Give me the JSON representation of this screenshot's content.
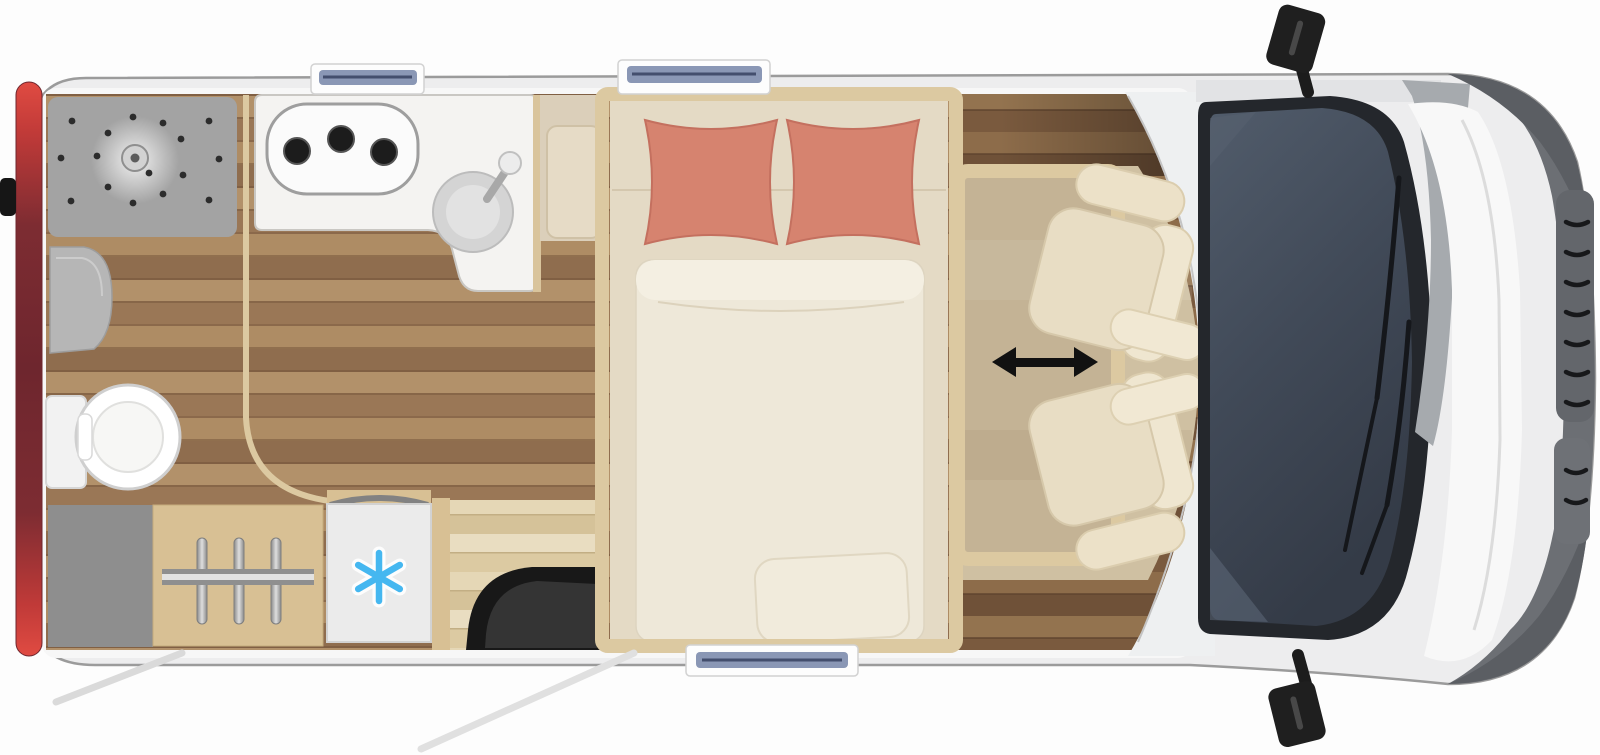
{
  "scene": {
    "type": "motorhome-floorplan-top-view",
    "vehicle_front": "right",
    "vehicle_rear": "left"
  },
  "colors": {
    "background": "#fdfdfd",
    "body_fill": "#ededee",
    "body_outline": "#9b9b9b",
    "wall_white": "#f7f7f7",
    "tail_light_bright": "#d94840",
    "tail_light_dark": "#6e262e",
    "floor_wood": "#a8875f",
    "floor_wood_dark": "#8a6848",
    "floor_pale": "#e4d6b6",
    "carpet_tan": "#cfc0a2",
    "furniture_beige": "#d8c094",
    "frame_beige": "#dcc9a1",
    "pillow_coral": "#d6836f",
    "headboard_cream": "#e4dac5",
    "duvet_cream": "#eee8d9",
    "seat_cream": "#e8ddc4",
    "counter_white": "#f4f3f1",
    "shower_gray": "#a3a3a3",
    "cabinet_gray": "#8e8e8e",
    "fridge_white": "#ebebeb",
    "snowflake_blue": "#45b7f0",
    "window_glass_blue": "#8a97b5",
    "windshield_glass": "#454e5c",
    "windshield_frame": "#24272c",
    "step_black": "#181818",
    "arrow_black": "#111111",
    "mirror_black": "#1f1f1f",
    "hood_white": "#f8f8f8",
    "front_rim_gray": "#6c6f74"
  },
  "zones": {
    "bathroom": {
      "fixtures": [
        "shower-tray",
        "shower-head",
        "washbasin",
        "toilet",
        "curved-partition-door"
      ],
      "shower_drain_holes": 16
    },
    "kitchen": {
      "fixtures": [
        "l-shaped-counter",
        "hob",
        "round-sink",
        "faucet"
      ],
      "hob_burners": 3
    },
    "storage": {
      "fixtures": [
        "gray-cabinet",
        "wardrobe",
        "refrigerator"
      ],
      "wardrobe_hangers": 3,
      "fridge_icon": "snowflake-icon"
    },
    "bedroom": {
      "fixtures": [
        "lengthways-double-bed",
        "duvet"
      ],
      "pillows": 2
    },
    "dinette": {
      "fixtures": [
        "sliding-table",
        "swivel-seats"
      ],
      "seats": 2,
      "indicator": "double-arrow-icon"
    },
    "cab": {
      "fixtures": [
        "windshield",
        "wipers",
        "hood",
        "front-grille",
        "side-mirrors",
        "entry-step"
      ],
      "wipers": 2,
      "side_mirrors": 2
    },
    "openings": {
      "roof_windows_top_wall": 2,
      "window_bottom_wall": 1,
      "door_swing_lines": 2
    }
  }
}
